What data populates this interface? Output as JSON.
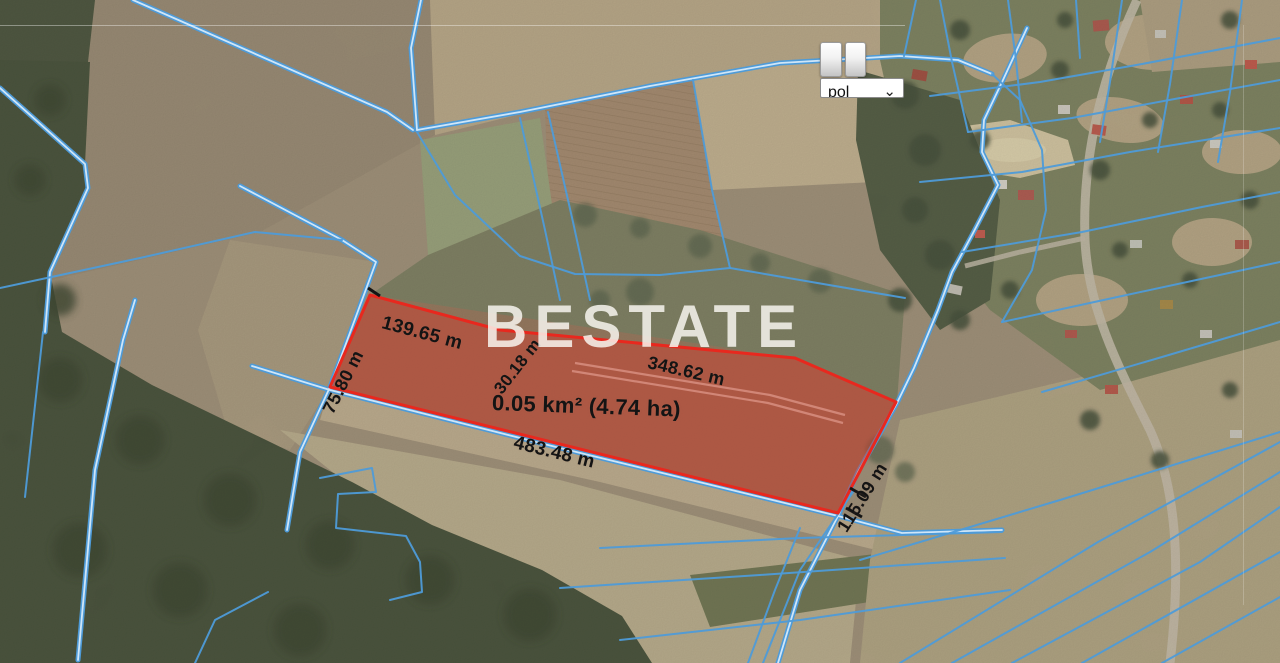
{
  "watermark": {
    "text": "BESTATE"
  },
  "parcel": {
    "area_label": "0.05 km² (4.74 ha)",
    "edge_labels": {
      "left": "75.80 m",
      "top_first": "139.65 m",
      "top_jog": "30.18 m",
      "top_second": "348.62 m",
      "bottom": "483.48 m",
      "right": "115.09 m"
    },
    "outline_color": "#e8281e"
  },
  "controls": {
    "language_select": {
      "value": "pol",
      "chevron": "⌄"
    }
  },
  "map": {
    "boundary_line_color": "#4e9bd8"
  }
}
